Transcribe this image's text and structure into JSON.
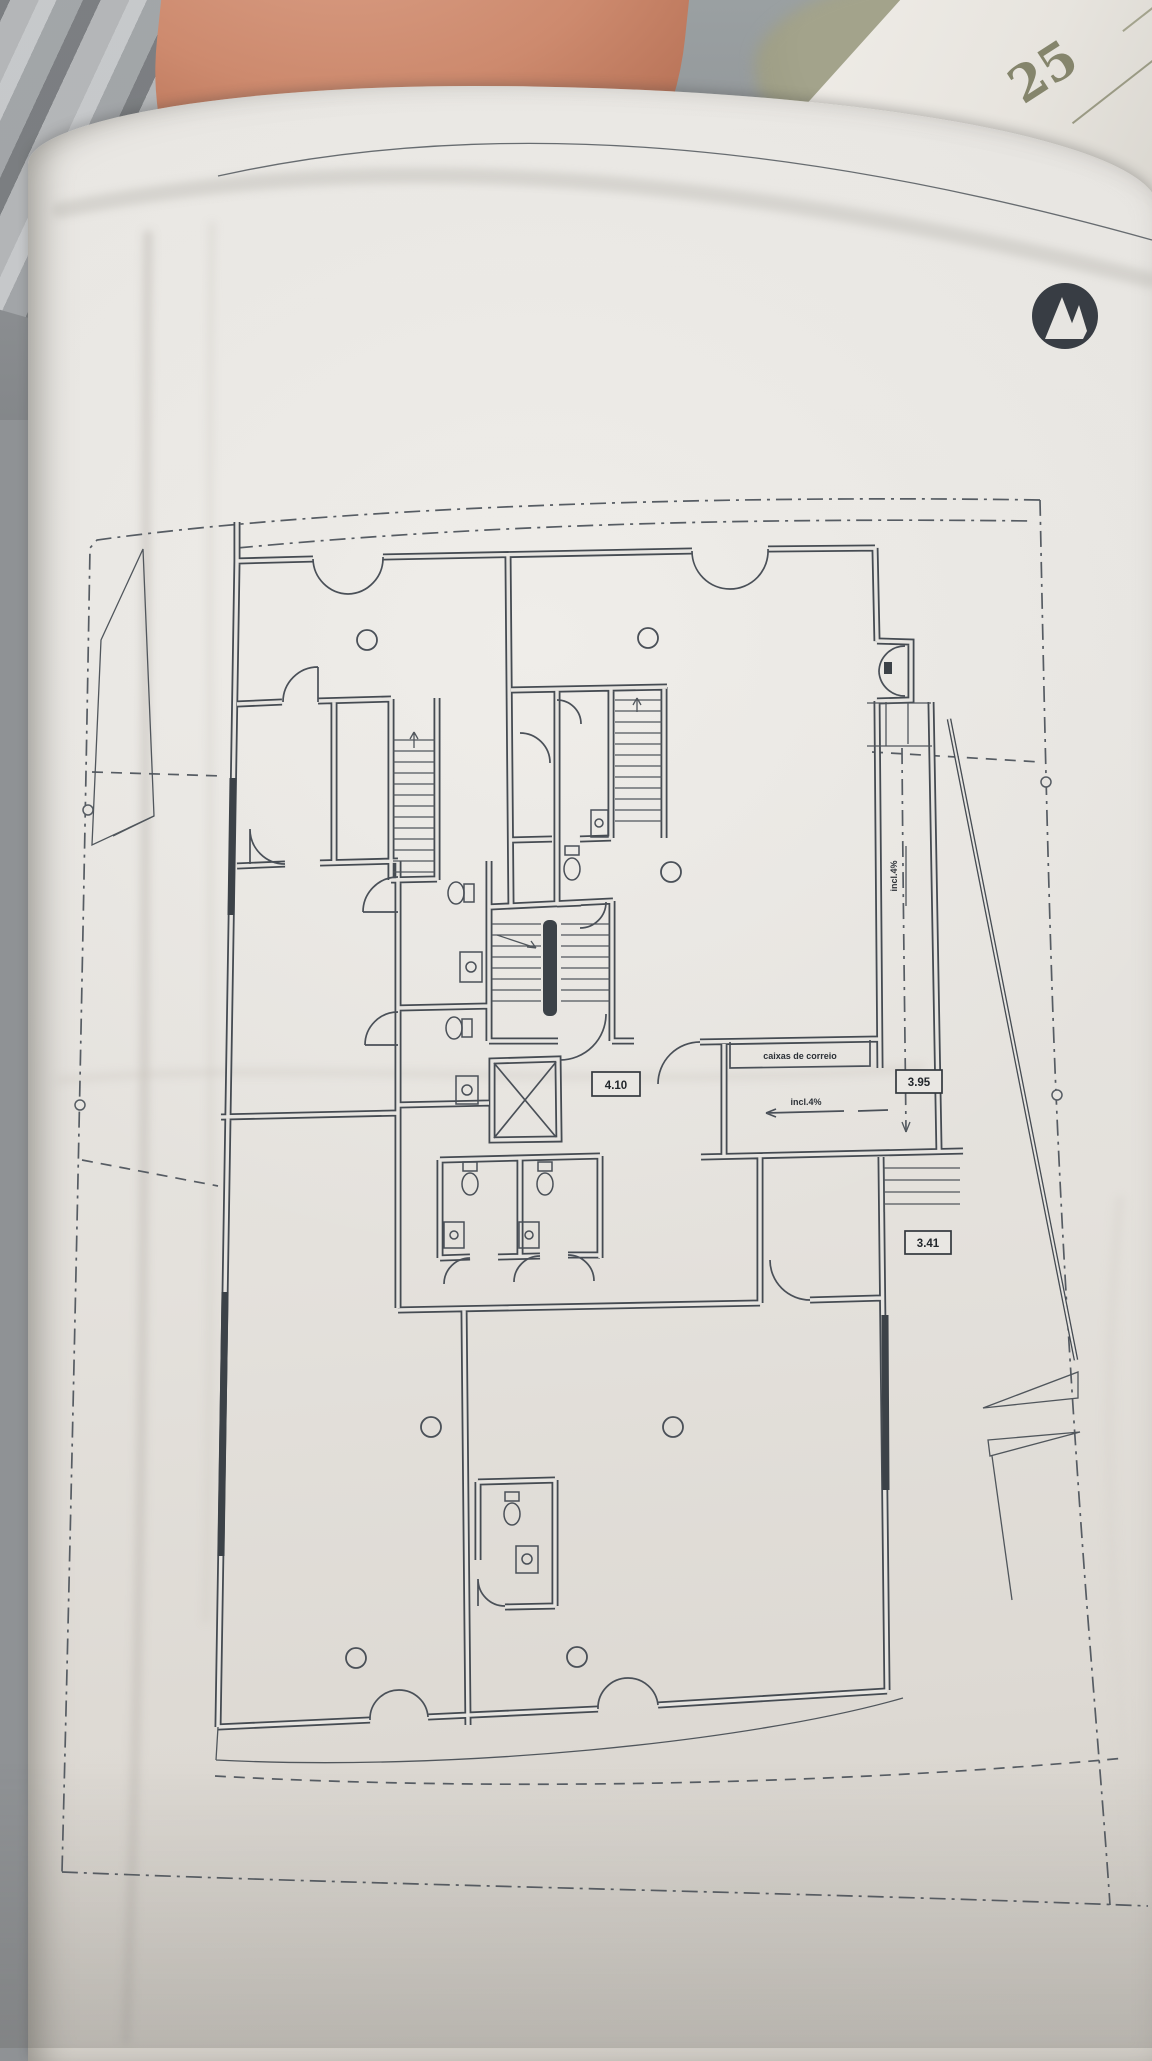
{
  "photo": {
    "handwritten_note": "25"
  },
  "plan": {
    "labels": {
      "mailboxes": "caixas de correio",
      "slope": "incl.4%",
      "slope_vertical": "incl.4%"
    },
    "dimensions": {
      "hall_width": "4.10",
      "ramp_upper": "3.95",
      "ramp_lower": "3.41"
    },
    "logo": "architect-logo",
    "colors": {
      "ink": "#454b52",
      "paper": "#e7e5e1",
      "leather": "#c9815f"
    }
  }
}
